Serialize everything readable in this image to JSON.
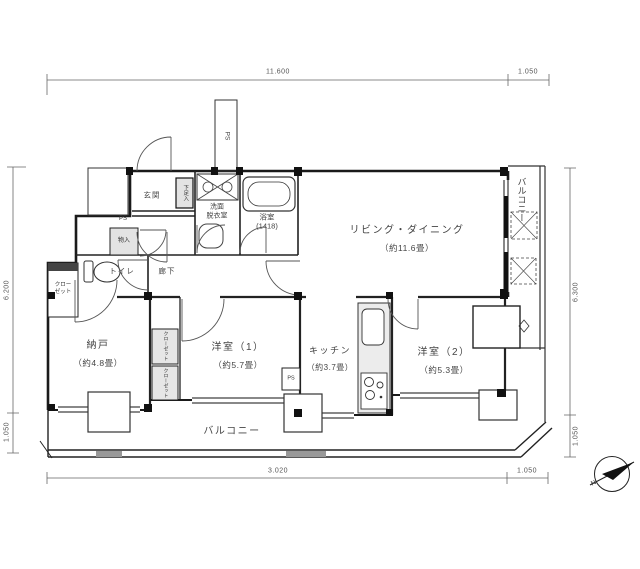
{
  "dims": {
    "top_main": "11.600",
    "top_right": "1.050",
    "left_main": "6.200",
    "left_bottom": "1.050",
    "right_main": "6.300",
    "right_bottom": "1.050",
    "bottom_main": "3.020",
    "bottom_right": "1.050"
  },
  "rooms": {
    "living_dining": {
      "name": "リビング・ダイニング",
      "area": "（約11.6畳）"
    },
    "nando": {
      "name": "納戸",
      "area": "（約4.8畳）"
    },
    "bedroom1": {
      "name": "洋室（1）",
      "area": "（約5.7畳）"
    },
    "kitchen": {
      "name": "キッチン",
      "area": "（約3.7畳）"
    },
    "bedroom2": {
      "name": "洋室（2）",
      "area": "（約5.3畳）"
    },
    "balcony": {
      "name": "バルコニー"
    },
    "side_balcony": {
      "name": "バルコニー"
    },
    "entrance": {
      "name": "玄関"
    },
    "hallway": {
      "name": "廊下"
    },
    "toilet": {
      "name": "トイレ"
    },
    "washroom": {
      "line1": "洗面",
      "line2": "脱衣室"
    },
    "bathroom": {
      "name": "浴室",
      "size": "(1418)"
    }
  },
  "fixtures": {
    "shoe_cabinet": "下足入",
    "mono_ire": "物入",
    "closet_left": {
      "line1": "クロー",
      "line2": "ゼット"
    },
    "closet_a": "クローゼット",
    "closet_b": "クローゼット",
    "ps_shaft": "PS",
    "ps_entrance": "PS",
    "ps_kitchen": "PS"
  },
  "compass": {
    "north": "N"
  },
  "colors": {
    "line": "#222222",
    "fixture_fill": "#e3e3e3",
    "dim_line": "#666666"
  }
}
